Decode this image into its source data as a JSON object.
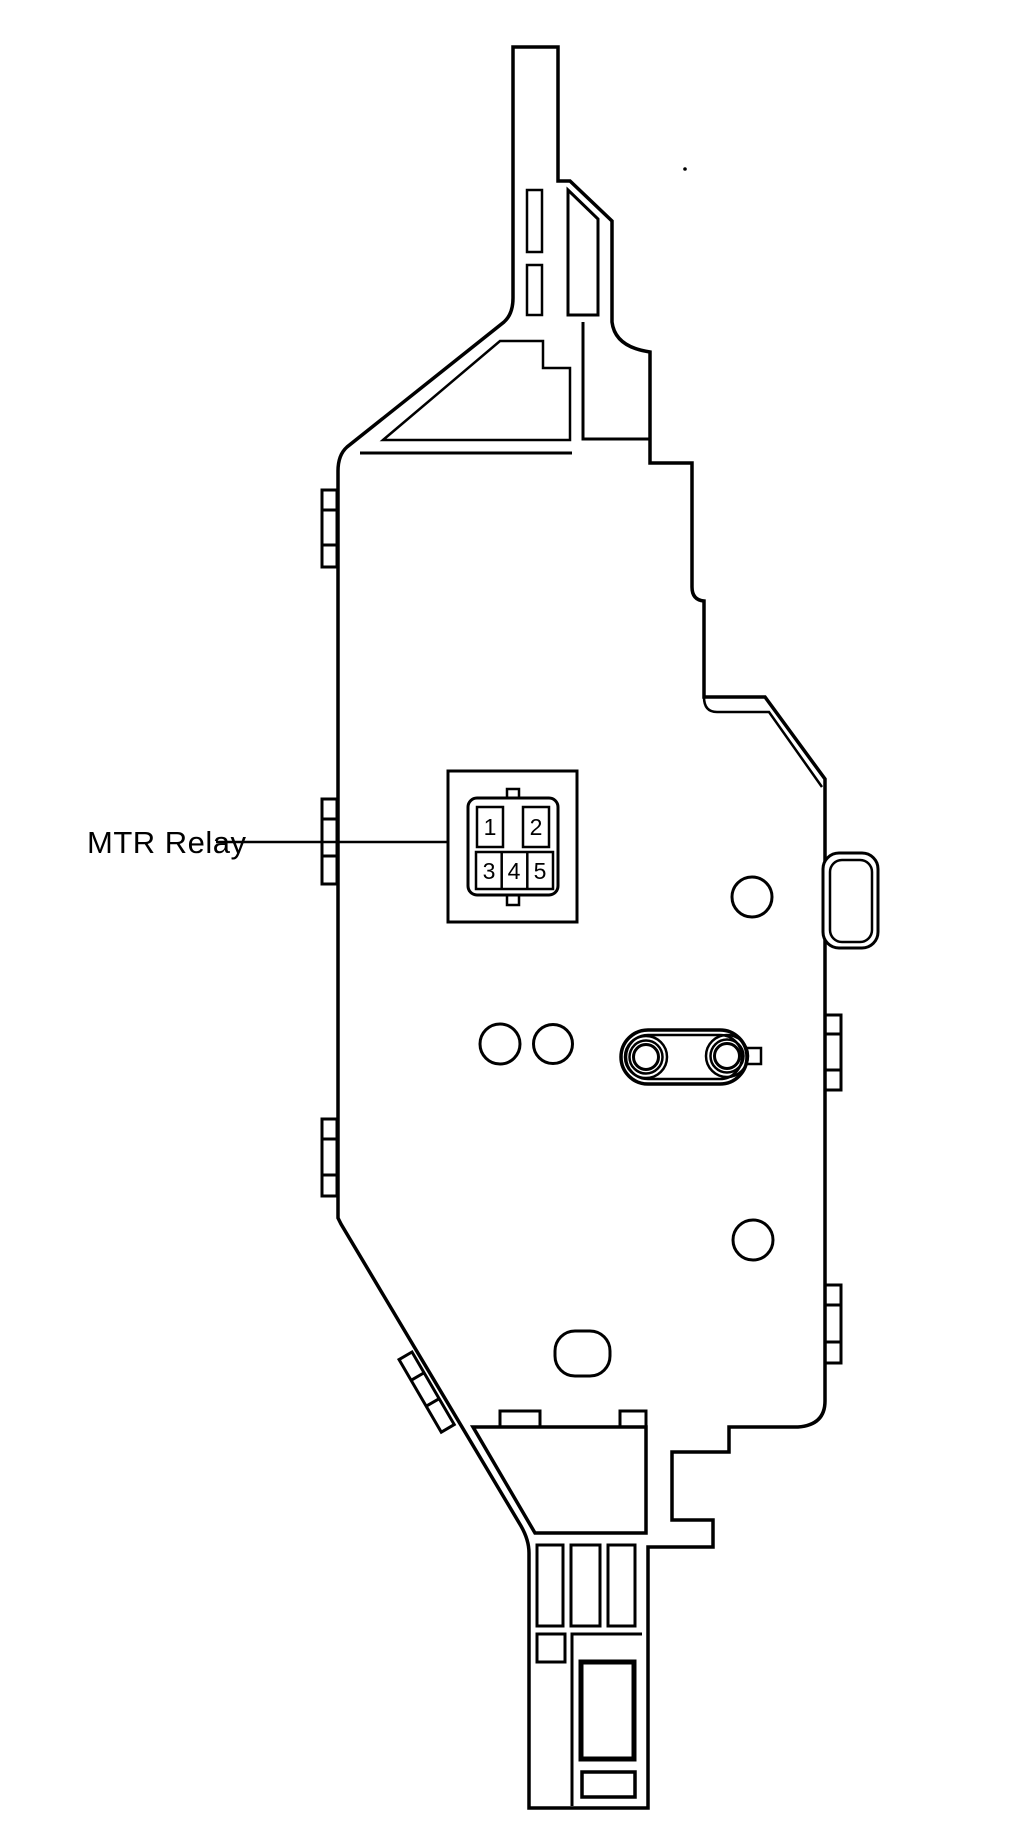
{
  "page": {
    "background": "#ffffff",
    "line_color": "#000000",
    "description_label": "MTR Relay"
  },
  "diagram": {
    "label": {
      "text": "MTR Relay"
    },
    "relay_connector": {
      "pins": [
        {
          "label": "1"
        },
        {
          "label": "2"
        },
        {
          "label": "3"
        },
        {
          "label": "4"
        },
        {
          "label": "5"
        }
      ]
    }
  }
}
